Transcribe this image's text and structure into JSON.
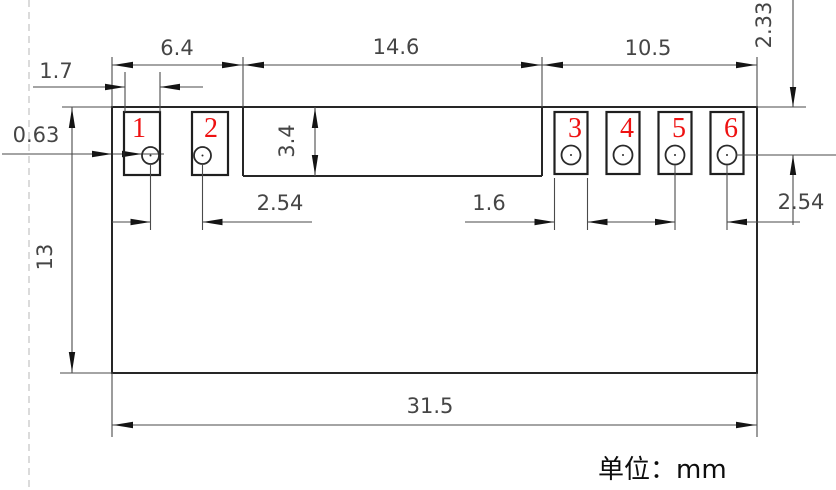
{
  "drawing": {
    "title": "connector-footprint-dimension-drawing",
    "unit_note": "单位：mm",
    "dimensions": {
      "left_section_width": "6.4",
      "middle_section_width": "14.6",
      "right_section_width": "10.5",
      "left_pad_width": "1.7",
      "edge_to_hole": "0.63",
      "section_height": "3.4",
      "top_to_pin_row": "2.33",
      "left_pin_pitch": "2.54",
      "right_pad_width": "1.6",
      "right_pin_pitch": "2.54",
      "body_height": "13",
      "overall_width": "31.5"
    },
    "pads": [
      {
        "number": "1"
      },
      {
        "number": "2"
      },
      {
        "number": "3"
      },
      {
        "number": "4"
      },
      {
        "number": "5"
      },
      {
        "number": "6"
      }
    ],
    "colors": {
      "outline": "#262626",
      "dimension": "#4a4a4a",
      "pad_number_red": "#ee1111",
      "centerline_gray": "#c3c3c3",
      "background": "#ffffff"
    }
  }
}
